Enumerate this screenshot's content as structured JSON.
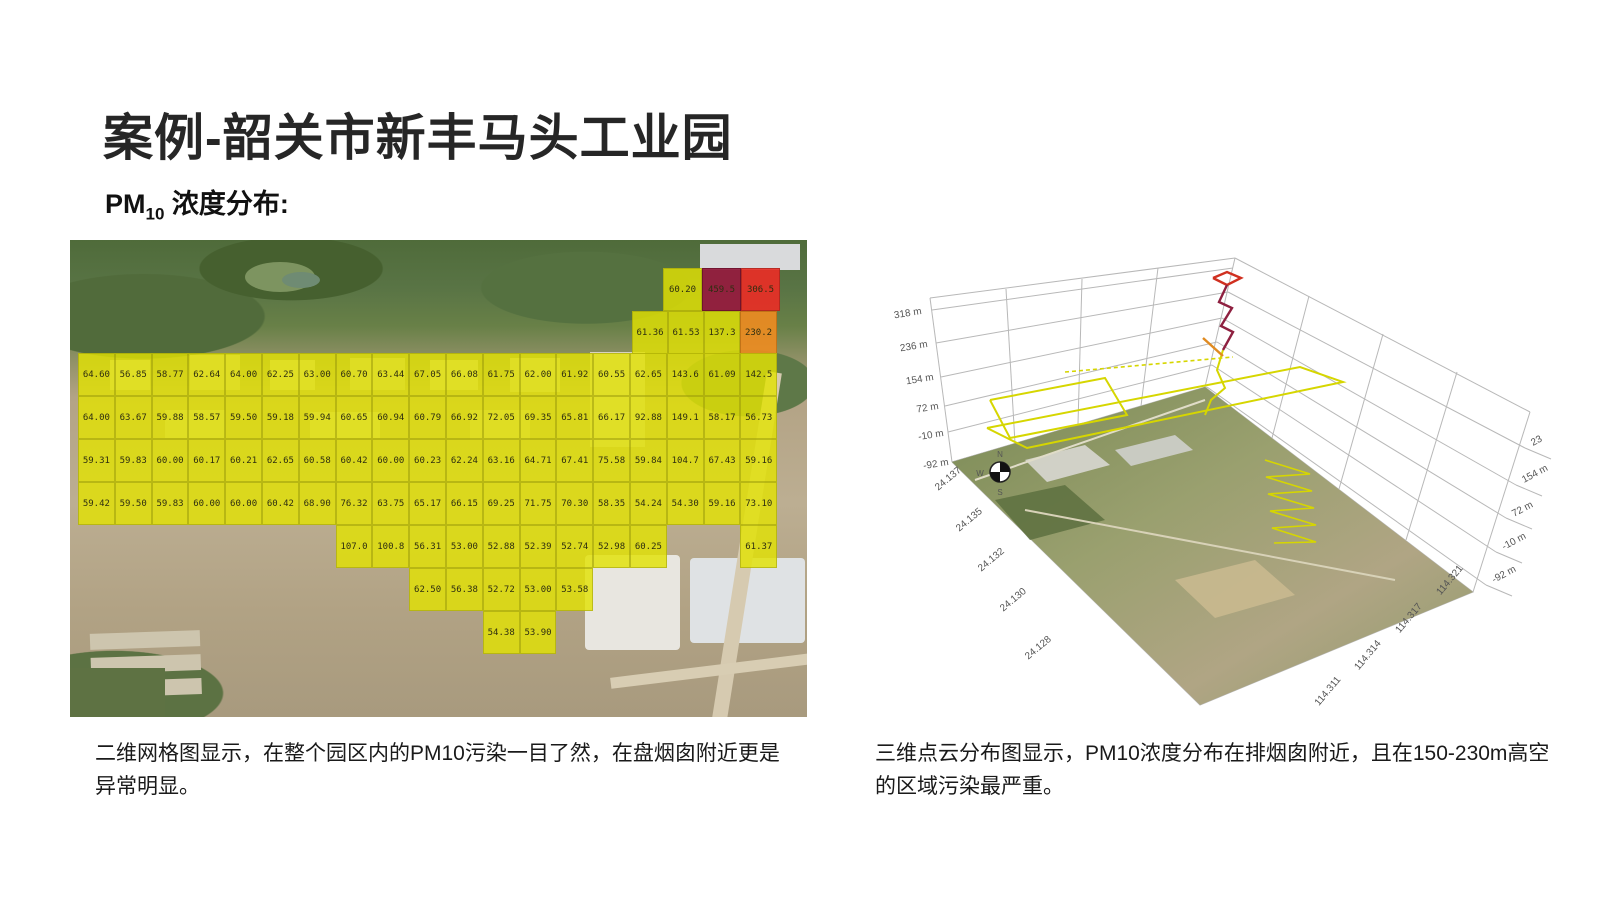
{
  "slide": {
    "title": "案例-韶关市新丰马头工业园",
    "subtitle": {
      "prefix": "PM",
      "sub": "10",
      "suffix": " 浓度分布:"
    },
    "caption_left": "二维网格图显示，在整个园区内的PM10污染一目了然，在盘烟囱附近更是异常明显。",
    "caption_right": "三维点云分布图显示，PM10浓度分布在排烟囱附近，且在150-230m高空的区域污染最严重。"
  },
  "colors": {
    "cell_yellow": "#e2e204",
    "cell_orange": "#ee8c20",
    "cell_red": "#e82e26",
    "cell_darkred": "#94203e",
    "path_yellow": "#d6d600",
    "path_red": "#d03020",
    "path_darkred": "#8e2040",
    "path_orange": "#e08a20"
  },
  "grid_map": {
    "cell_w": 36.8,
    "cell_h": 43,
    "origin_x": 8,
    "rows": [
      {
        "name": "top-row-1",
        "top": 28,
        "cells": [
          {
            "x": 593,
            "w": 39,
            "v": "60.20",
            "c": "y"
          },
          {
            "x": 632,
            "w": 39,
            "v": "459.5",
            "c": "d"
          },
          {
            "x": 671,
            "w": 39,
            "v": "306.5",
            "c": "r"
          }
        ]
      },
      {
        "name": "top-row-2",
        "top": 71,
        "cells": [
          {
            "x": 562,
            "w": 36,
            "v": "61.36",
            "c": "y"
          },
          {
            "x": 598,
            "w": 36,
            "v": "61.53",
            "c": "y"
          },
          {
            "x": 634,
            "w": 36,
            "v": "137.3",
            "c": "y"
          },
          {
            "x": 670,
            "w": 37,
            "v": "230.2",
            "c": "o"
          }
        ]
      },
      {
        "name": "row-1",
        "top": 113,
        "cells": [
          {
            "col": 1,
            "v": "64.60"
          },
          {
            "col": 2,
            "v": "56.85"
          },
          {
            "col": 3,
            "v": "58.77"
          },
          {
            "col": 4,
            "v": "62.64"
          },
          {
            "col": 5,
            "v": "64.00"
          },
          {
            "col": 6,
            "v": "62.25"
          },
          {
            "col": 7,
            "v": "63.00"
          },
          {
            "col": 8,
            "v": "60.70"
          },
          {
            "col": 9,
            "v": "63.44"
          },
          {
            "col": 10,
            "v": "67.05"
          },
          {
            "col": 11,
            "v": "66.08"
          },
          {
            "col": 12,
            "v": "61.75"
          },
          {
            "col": 13,
            "v": "62.00"
          },
          {
            "col": 14,
            "v": "61.92"
          },
          {
            "col": 15,
            "v": "60.55"
          },
          {
            "col": 16,
            "v": "62.65"
          },
          {
            "col": 17,
            "v": "143.6"
          },
          {
            "col": 18,
            "v": "61.09"
          },
          {
            "col": 19,
            "v": "142.5"
          }
        ]
      },
      {
        "name": "row-2",
        "top": 156,
        "cells": [
          {
            "col": 1,
            "v": "64.00"
          },
          {
            "col": 2,
            "v": "63.67"
          },
          {
            "col": 3,
            "v": "59.88"
          },
          {
            "col": 4,
            "v": "58.57"
          },
          {
            "col": 5,
            "v": "59.50"
          },
          {
            "col": 6,
            "v": "59.18"
          },
          {
            "col": 7,
            "v": "59.94"
          },
          {
            "col": 8,
            "v": "60.65"
          },
          {
            "col": 9,
            "v": "60.94"
          },
          {
            "col": 10,
            "v": "60.79"
          },
          {
            "col": 11,
            "v": "66.92"
          },
          {
            "col": 12,
            "v": "72.05"
          },
          {
            "col": 13,
            "v": "69.35"
          },
          {
            "col": 14,
            "v": "65.81"
          },
          {
            "col": 15,
            "v": "66.17"
          },
          {
            "col": 16,
            "v": "92.88"
          },
          {
            "col": 17,
            "v": "149.1"
          },
          {
            "col": 18,
            "v": "58.17"
          },
          {
            "col": 19,
            "v": "56.73"
          }
        ]
      },
      {
        "name": "row-3",
        "top": 199,
        "cells": [
          {
            "col": 1,
            "v": "59.31"
          },
          {
            "col": 2,
            "v": "59.83"
          },
          {
            "col": 3,
            "v": "60.00"
          },
          {
            "col": 4,
            "v": "60.17"
          },
          {
            "col": 5,
            "v": "60.21"
          },
          {
            "col": 6,
            "v": "62.65"
          },
          {
            "col": 7,
            "v": "60.58"
          },
          {
            "col": 8,
            "v": "60.42"
          },
          {
            "col": 9,
            "v": "60.00"
          },
          {
            "col": 10,
            "v": "60.23"
          },
          {
            "col": 11,
            "v": "62.24"
          },
          {
            "col": 12,
            "v": "63.16"
          },
          {
            "col": 13,
            "v": "64.71"
          },
          {
            "col": 14,
            "v": "67.41"
          },
          {
            "col": 15,
            "v": "75.58"
          },
          {
            "col": 16,
            "v": "59.84"
          },
          {
            "col": 17,
            "v": "104.7"
          },
          {
            "col": 18,
            "v": "67.43"
          },
          {
            "col": 19,
            "v": "59.16"
          }
        ]
      },
      {
        "name": "row-4",
        "top": 242,
        "cells": [
          {
            "col": 1,
            "v": "59.42"
          },
          {
            "col": 2,
            "v": "59.50"
          },
          {
            "col": 3,
            "v": "59.83"
          },
          {
            "col": 4,
            "v": "60.00"
          },
          {
            "col": 5,
            "v": "60.00"
          },
          {
            "col": 6,
            "v": "60.42"
          },
          {
            "col": 7,
            "v": "68.90"
          },
          {
            "col": 8,
            "v": "76.32"
          },
          {
            "col": 9,
            "v": "63.75"
          },
          {
            "col": 10,
            "v": "65.17"
          },
          {
            "col": 11,
            "v": "66.15"
          },
          {
            "col": 12,
            "v": "69.25"
          },
          {
            "col": 13,
            "v": "71.75"
          },
          {
            "col": 14,
            "v": "70.30"
          },
          {
            "col": 15,
            "v": "58.35"
          },
          {
            "col": 16,
            "v": "54.24"
          },
          {
            "col": 17,
            "v": "54.30"
          },
          {
            "col": 18,
            "v": "59.16"
          },
          {
            "col": 19,
            "v": "73.10"
          }
        ]
      },
      {
        "name": "row-5",
        "top": 285,
        "cells": [
          {
            "col": 8,
            "v": "107.0"
          },
          {
            "col": 9,
            "v": "100.8"
          },
          {
            "col": 10,
            "v": "56.31"
          },
          {
            "col": 11,
            "v": "53.00"
          },
          {
            "col": 12,
            "v": "52.88"
          },
          {
            "col": 13,
            "v": "52.39"
          },
          {
            "col": 14,
            "v": "52.74"
          },
          {
            "col": 15,
            "v": "52.98"
          },
          {
            "col": 16,
            "v": "60.25"
          },
          {
            "col": 19,
            "v": "61.37"
          }
        ]
      },
      {
        "name": "row-6",
        "top": 328,
        "cells": [
          {
            "col": 10,
            "v": "62.50"
          },
          {
            "col": 11,
            "v": "56.38"
          },
          {
            "col": 12,
            "v": "52.72"
          },
          {
            "col": 13,
            "v": "53.00"
          },
          {
            "col": 14,
            "v": "53.58"
          }
        ]
      },
      {
        "name": "row-7",
        "top": 371,
        "cells": [
          {
            "col": 12,
            "v": "54.38"
          },
          {
            "col": 13,
            "v": "53.90"
          }
        ]
      }
    ]
  },
  "plot3d": {
    "z_ticks_left": [
      "318 m",
      "236 m",
      "154 m",
      "72 m",
      "-10 m",
      "-92 m"
    ],
    "z_ticks_right": [
      "23",
      "154 m",
      "72 m",
      "-10 m",
      "-92 m"
    ],
    "lat_ticks": [
      "24.137",
      "24.135",
      "24.132",
      "24.130",
      "24.128"
    ],
    "lng_ticks": [
      "114.321",
      "114.317",
      "114.314",
      "114.311"
    ],
    "compass": [
      "N",
      "W",
      "S"
    ]
  }
}
